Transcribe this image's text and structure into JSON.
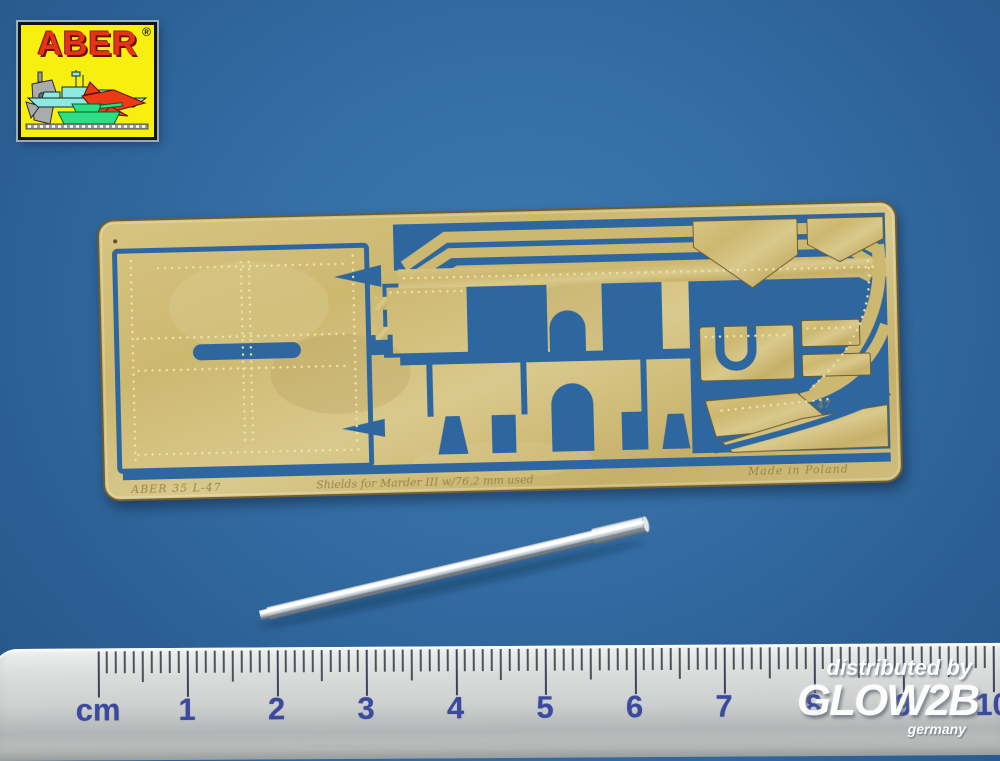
{
  "page": {
    "background_color": "#31699f"
  },
  "logo": {
    "brand": "ABER",
    "registered_mark": "®",
    "background_color": "#f7ef10",
    "brand_color": "#e5321a",
    "icons": [
      "battleship-icon",
      "fighter-jet-icon",
      "tank-icon",
      "submarine-icon",
      "scale-strip"
    ]
  },
  "fret": {
    "material_color": "#cdb873",
    "cutout_color": "#2e679f",
    "etched_text_left": "ABER  35 L-47",
    "etched_text_center": "Shields for Marder III w/76,2 mm used",
    "etched_text_right": "Made in Poland",
    "part_marking": "47"
  },
  "barrel": {
    "color": "#d9dee3"
  },
  "ruler": {
    "unit_label": "cm",
    "numbers": [
      "1",
      "2",
      "3",
      "4",
      "5",
      "6",
      "7",
      "8",
      "9",
      "10"
    ],
    "number_color": "#3b4a9c",
    "tick_color": "#2c313c",
    "body_color": "#d8dad9"
  },
  "watermark": {
    "line1": "distributed by",
    "brand": "GLOW2B",
    "country": "germany",
    "color": "#ffffff"
  }
}
